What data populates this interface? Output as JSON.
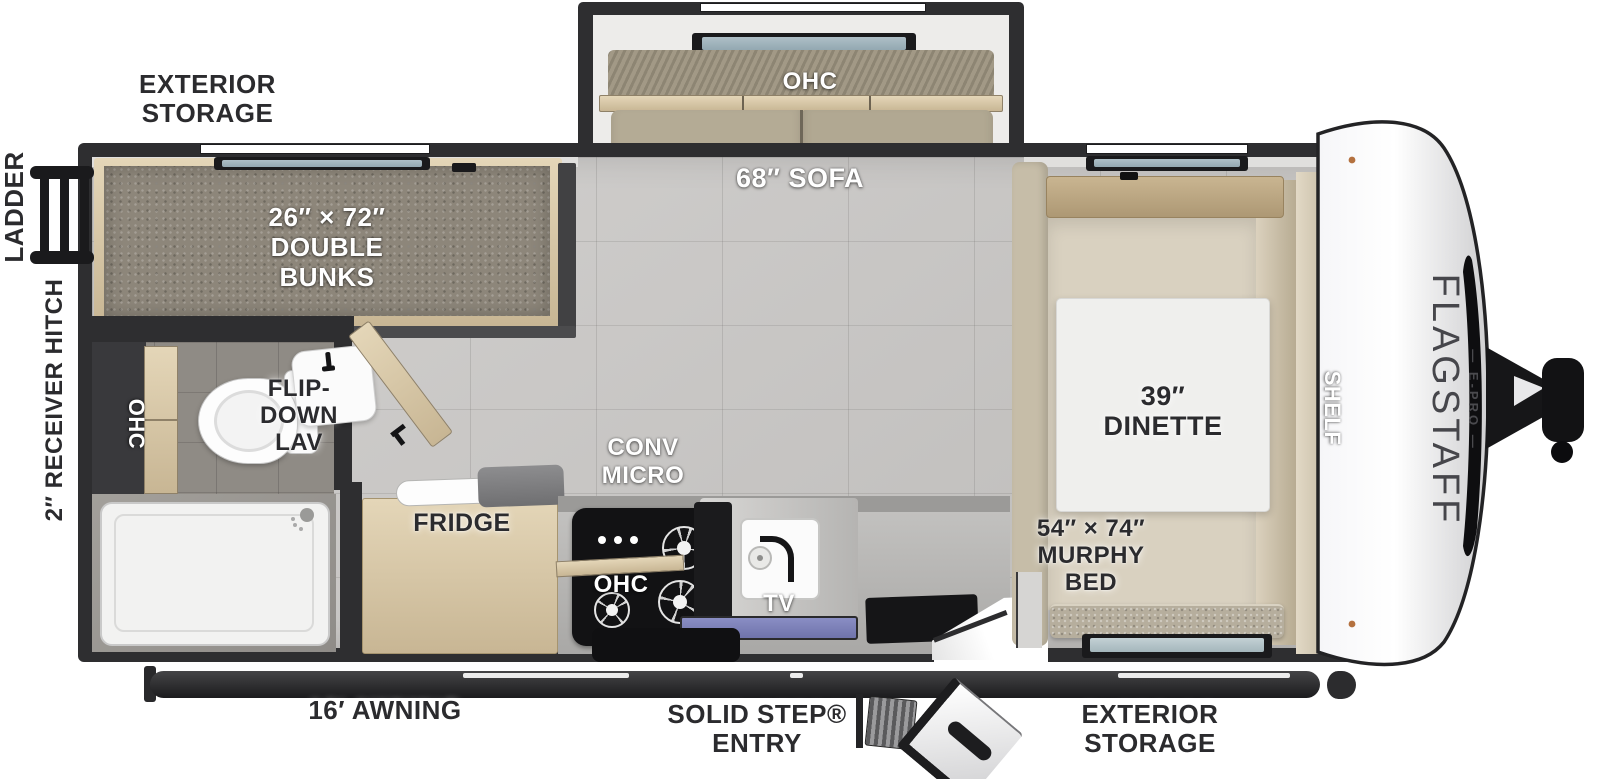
{
  "brand": {
    "name": "FLAGSTAFF",
    "sub": "— E-PRO —"
  },
  "labels": {
    "ladder": "LADDER",
    "receiver_hitch": "2″ RECEIVER HITCH",
    "exterior_storage_top": "EXTERIOR\nSTORAGE",
    "double_bunks": "26″ × 72″\nDOUBLE\nBUNKS",
    "sofa_ohc": "OHC",
    "sofa": "68″ SOFA",
    "bath_ohc": "OHC",
    "flip_down_lav": "FLIP-\nDOWN\nLAV",
    "conv_micro": "CONV\nMICRO",
    "fridge": "FRIDGE",
    "kitchen_ohc": "OHC",
    "tv": "TV",
    "dinette": "39″\nDINETTE",
    "shelf": "SHELF",
    "murphy_bed": "54″ × 74″\nMURPHY\nBED",
    "awning": "16′ AWNING",
    "entry": "SOLID STEP®\nENTRY",
    "exterior_storage_bottom": "EXTERIOR\nSTORAGE"
  },
  "colors": {
    "wall": "#2e2e30",
    "floor": "#cbc9c7",
    "carpet": "#8d867a",
    "wood": "#d5c4a2",
    "sofa": "#b4ab95",
    "counter": "#b5b4b2",
    "cooktop": "#121214",
    "window_glass": "#a3b7c0",
    "kitchen_window_glass": "#8a8ec4",
    "label_dark": "#2b2b2e",
    "label_light": "#ffffff",
    "front_cap": "#f2f2f4",
    "awning_bar": "#2a2a2c"
  }
}
